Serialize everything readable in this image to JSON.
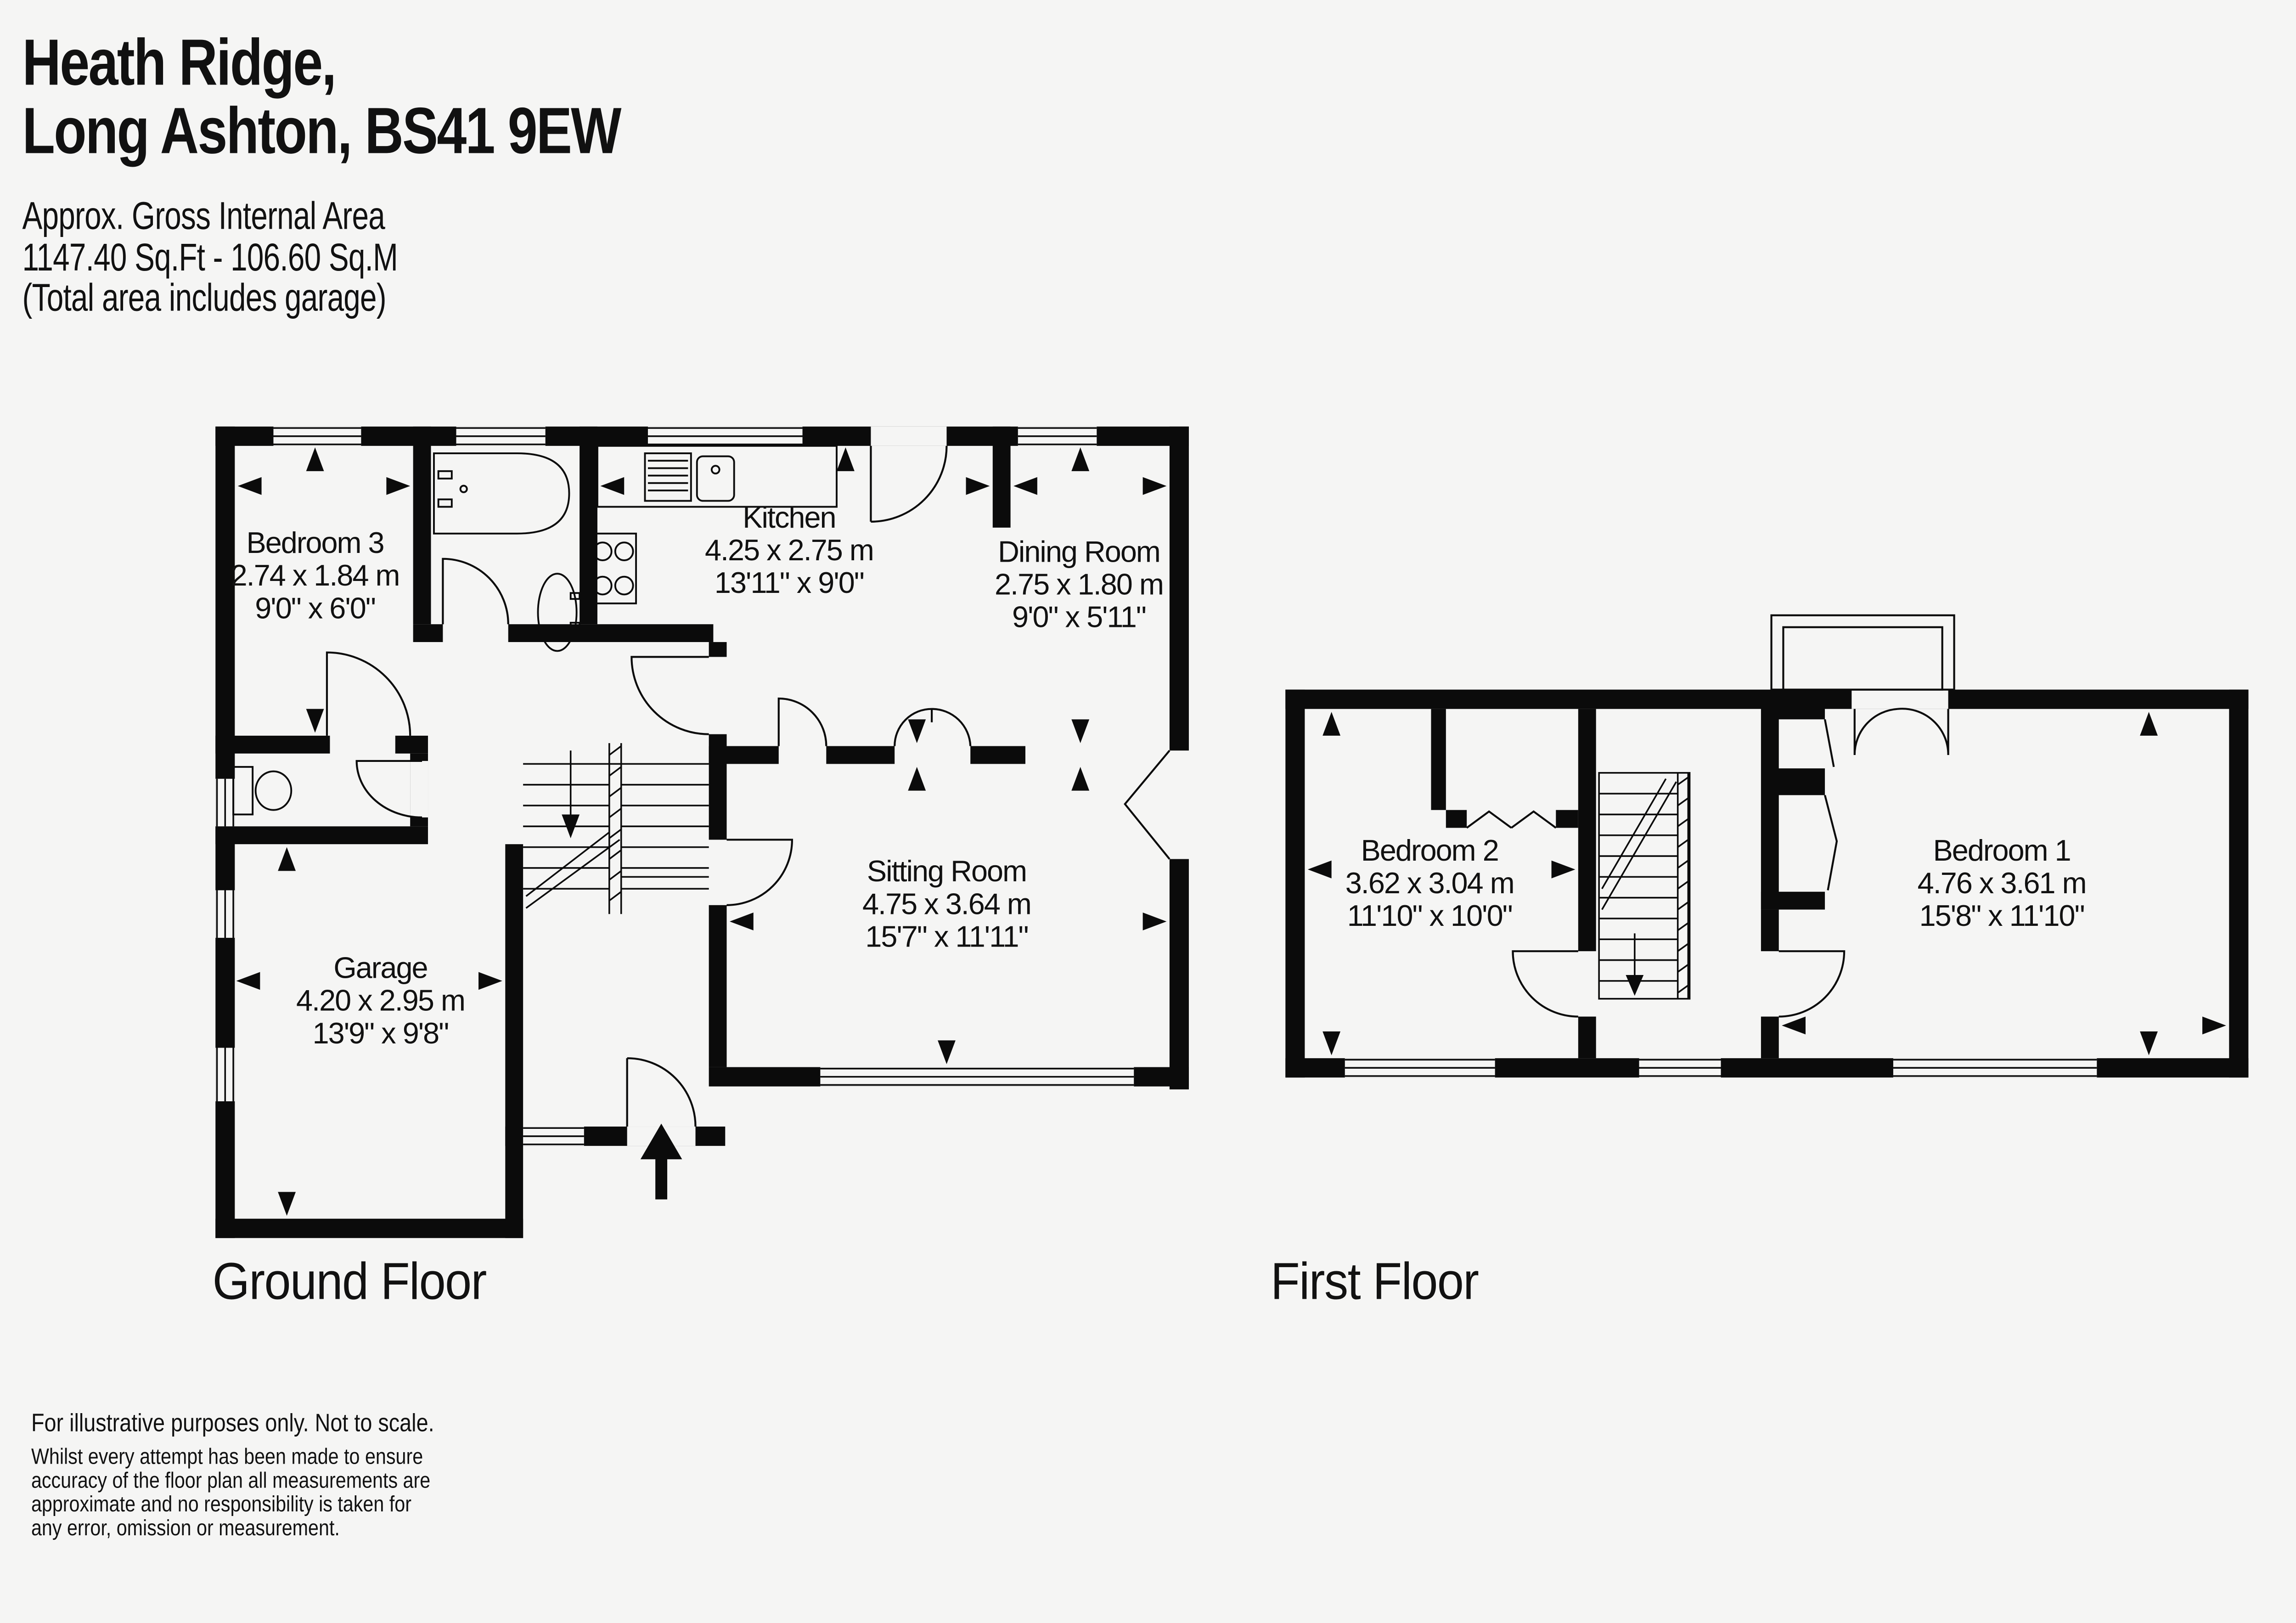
{
  "header": {
    "title_line1": "Heath Ridge,",
    "title_line2": "Long Ashton, BS41 9EW",
    "area_label": "Approx. Gross Internal Area",
    "area_value": "1147.40 Sq.Ft - 106.60 Sq.M",
    "area_note": "(Total area includes garage)"
  },
  "ground_floor": {
    "label": "Ground Floor",
    "rooms": [
      {
        "name": "Bedroom 3",
        "metric": "2.74 x 1.84 m",
        "imperial": "9'0\" x 6'0\""
      },
      {
        "name": "Kitchen",
        "metric": "4.25 x 2.75 m",
        "imperial": "13'11\" x 9'0\""
      },
      {
        "name": "Dining Room",
        "metric": "2.75 x 1.80 m",
        "imperial": "9'0\" x 5'11\""
      },
      {
        "name": "Sitting Room",
        "metric": "4.75 x 3.64 m",
        "imperial": "15'7\" x 11'11\""
      },
      {
        "name": "Garage",
        "metric": "4.20 x 2.95 m",
        "imperial": "13'9\" x 9'8\""
      }
    ]
  },
  "first_floor": {
    "label": "First Floor",
    "rooms": [
      {
        "name": "Bedroom 2",
        "metric": "3.62 x 3.04 m",
        "imperial": "11'10\" x 10'0\""
      },
      {
        "name": "Bedroom 1",
        "metric": "4.76 x 3.61 m",
        "imperial": "15'8\" x 11'10\""
      }
    ]
  },
  "footer": {
    "line1": "For illustrative purposes only. Not to scale.",
    "disclaimer_lines": [
      "Whilst every attempt has been made to ensure",
      "accuracy of the floor plan all measurements are",
      "approximate and no responsibility is taken for",
      "any error, omission or measurement."
    ]
  },
  "colors": {
    "background": "#f5f5f4",
    "wall": "#0b0b0b",
    "text": "#111111"
  }
}
